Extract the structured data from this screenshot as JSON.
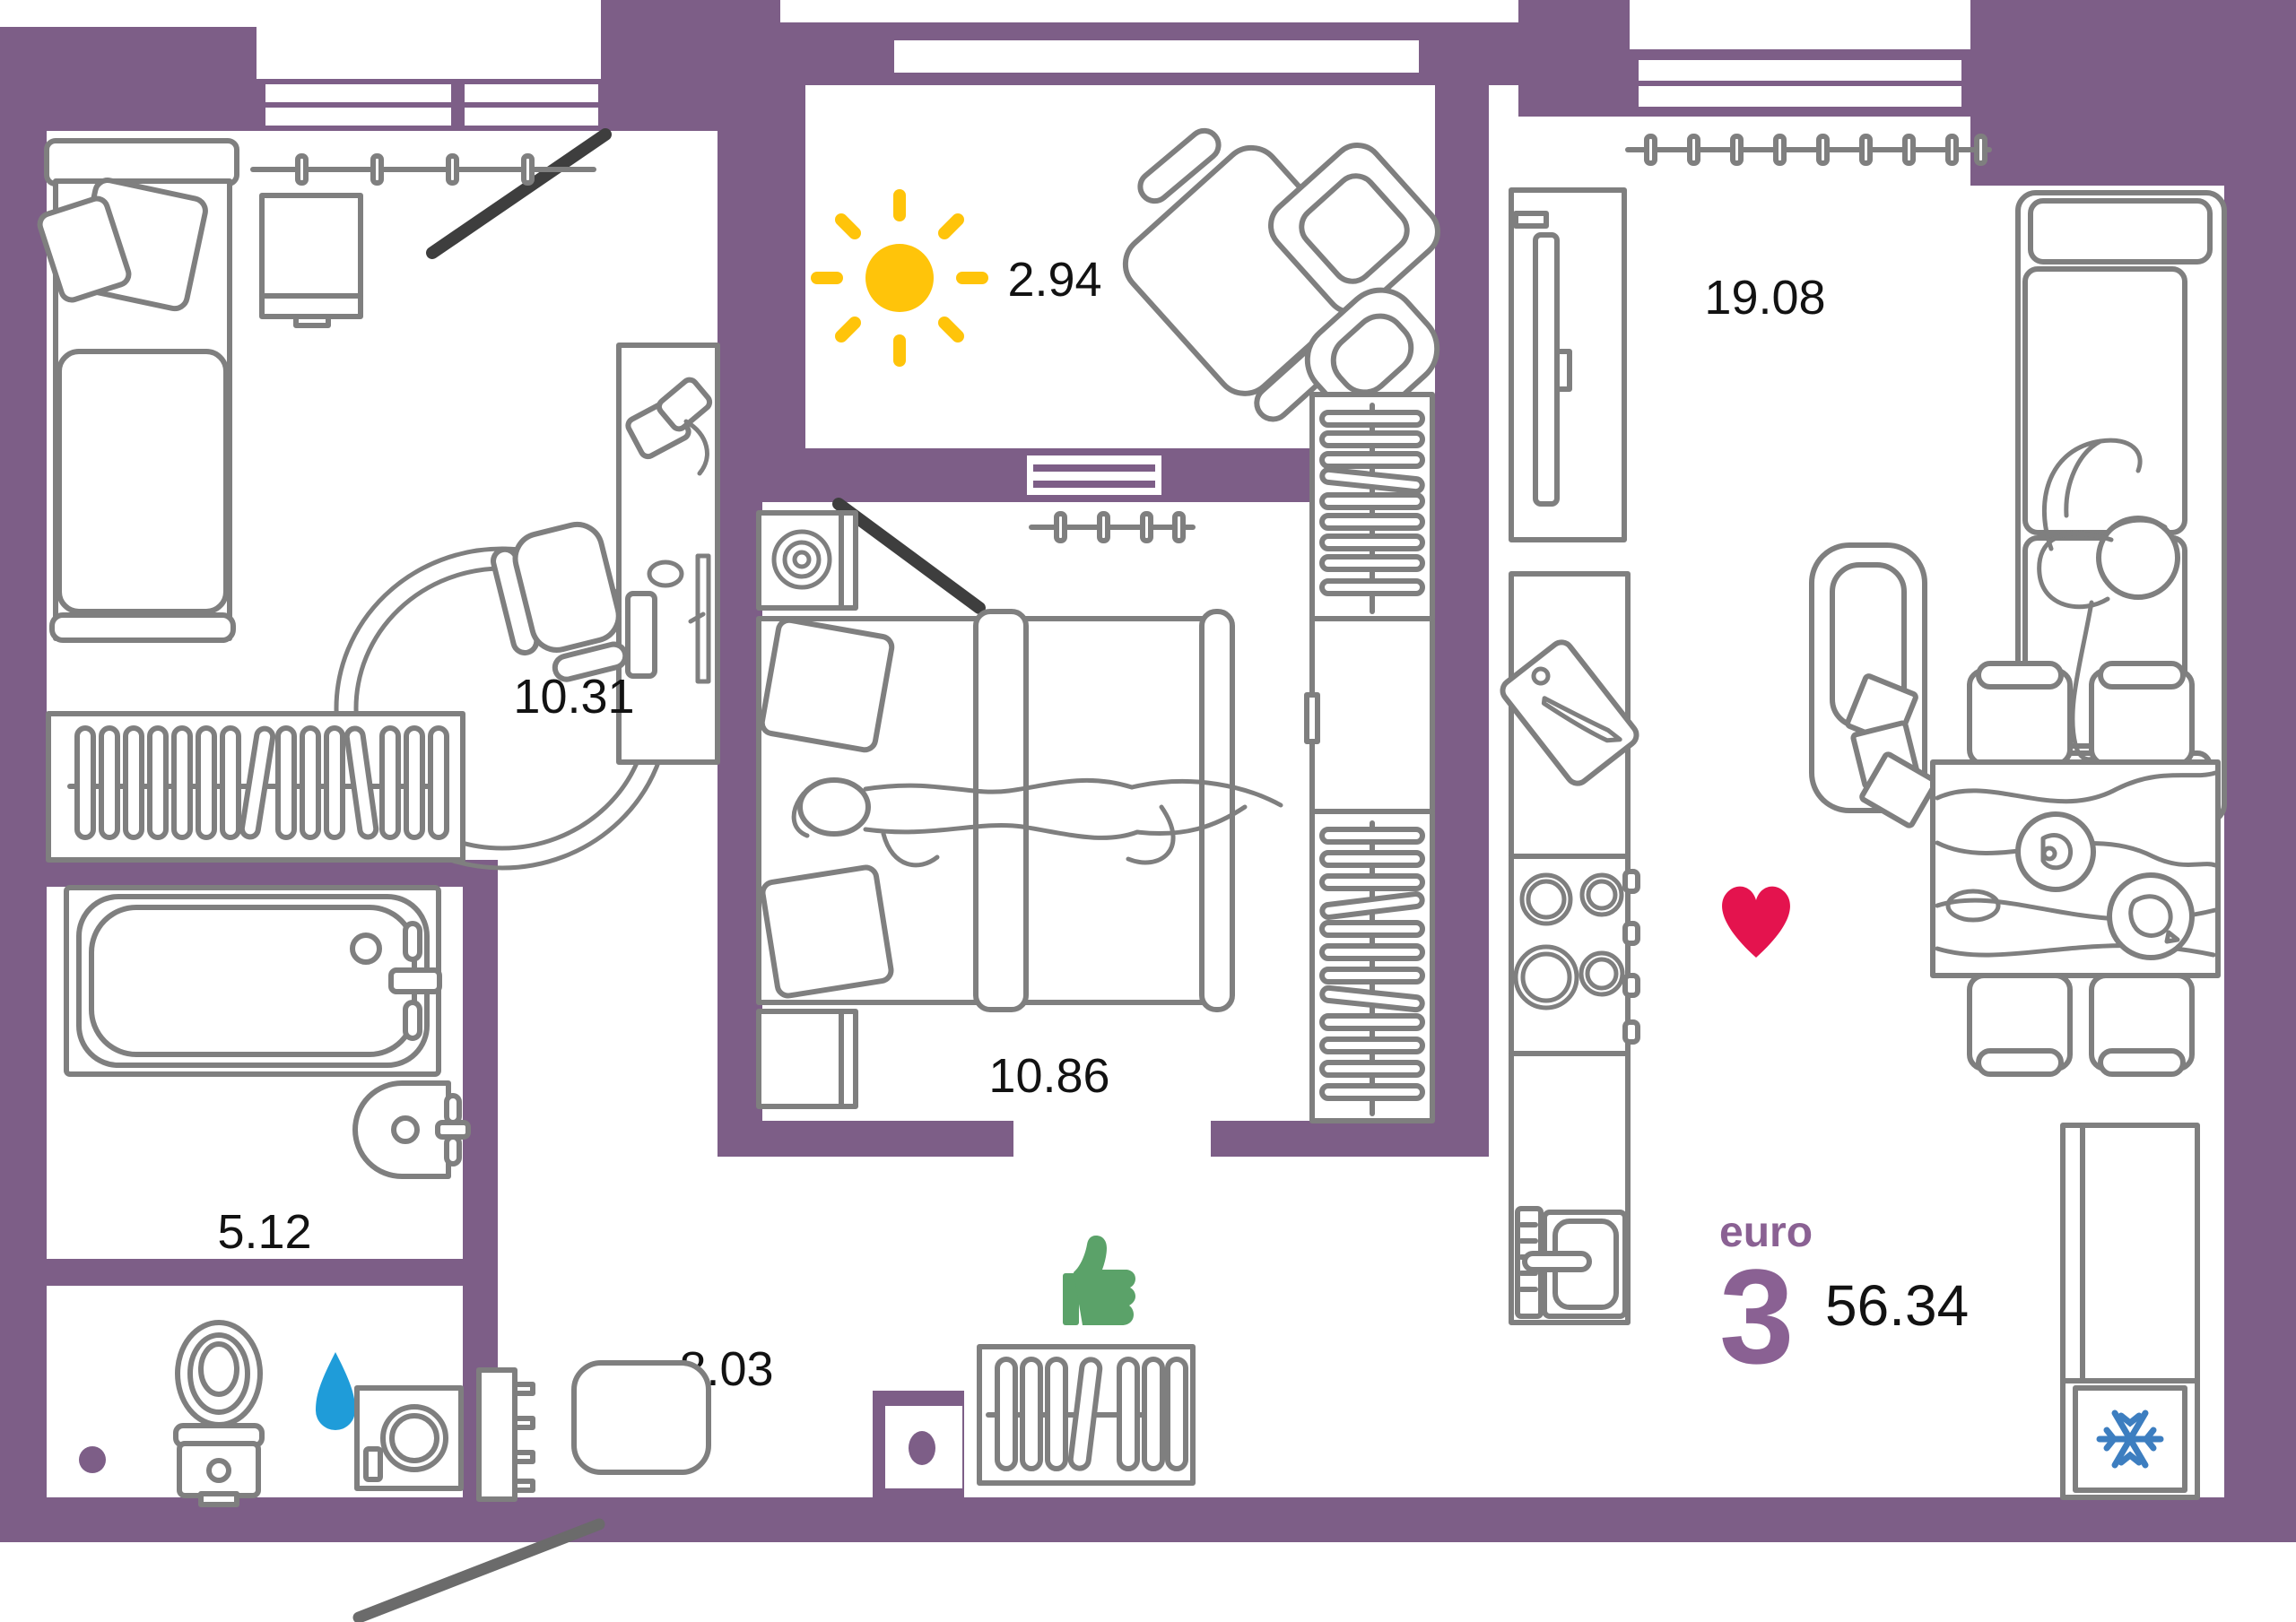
{
  "document": {
    "type": "apartment floor plan"
  },
  "unit": {
    "format_label": "euro",
    "rooms_count": "3",
    "total_area": "56.34"
  },
  "rooms": {
    "balcony": {
      "area": "2.94"
    },
    "living_kitchen": {
      "area": "19.08"
    },
    "bedroom_small": {
      "area": "10.31"
    },
    "bedroom_main": {
      "area": "10.86"
    },
    "bathroom": {
      "area": "5.12"
    },
    "hallway": {
      "area": "8.03"
    }
  },
  "icons": {
    "sun": "sun-icon",
    "heart": "heart-icon",
    "thumbs_up": "thumbs-up-icon",
    "water_drop": "water-drop-icon",
    "snowflake": "snowflake-icon"
  },
  "colors": {
    "wall": "#7D5E87",
    "furniture_stroke": "#7F7F7F",
    "sun": "#FFC40A",
    "heart": "#E4134E",
    "thumbs_up": "#5BA269",
    "water_drop": "#1F9CD9",
    "snowflake": "#3D7EC0",
    "accent_text": "#8A6193",
    "label_text": "#121212",
    "door_dark": "#3E3E3E",
    "door_entry": "#6B6B6B"
  }
}
